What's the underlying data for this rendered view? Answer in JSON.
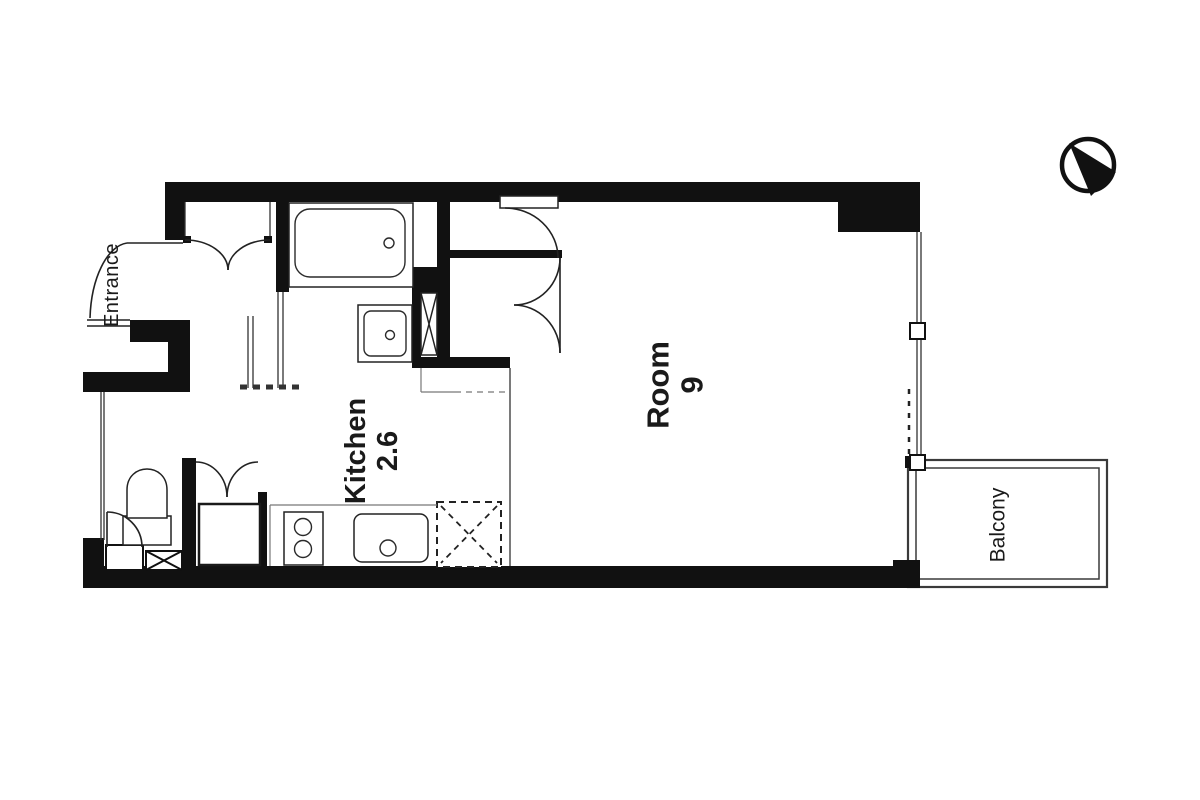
{
  "labels": {
    "entrance": "Entrance",
    "kitchen": {
      "name": "Kitchen",
      "area": "2.6"
    },
    "room": {
      "name": "Room",
      "area": "9"
    },
    "balcony": "Balcony"
  },
  "icons": {
    "compass": "north-arrow-compass",
    "shaft_box": "pipe-shaft-x-box",
    "fridge": "refrigerator-dashed-box"
  },
  "colors": {
    "walls": "#111111",
    "lines": "#222222",
    "light_lines": "#777777",
    "text": "#1a1a1a",
    "background": "#ffffff"
  }
}
